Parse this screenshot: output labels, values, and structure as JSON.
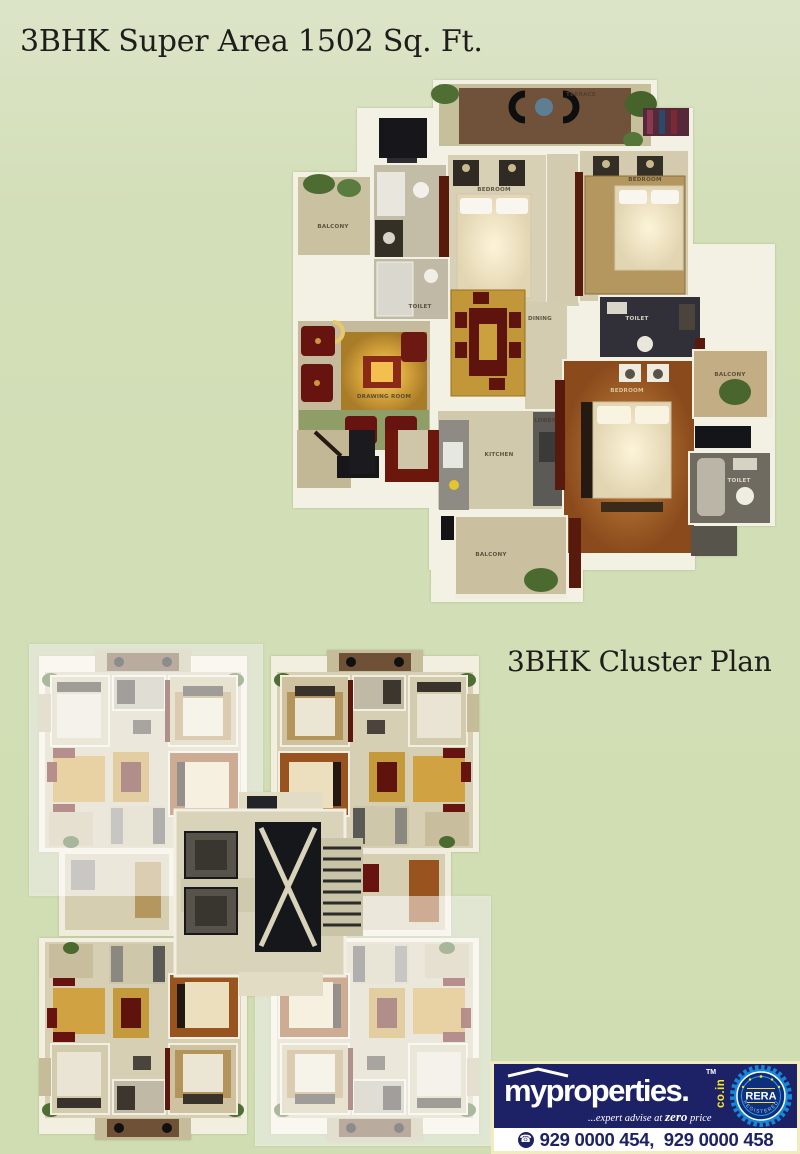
{
  "titles": {
    "main": "3BHK Super Area 1502 Sq. Ft.",
    "cluster": "3BHK Cluster Plan"
  },
  "floorplan": {
    "rooms": {
      "terrace": "TERRACE",
      "balcony_left": "BALCONY",
      "toilet_left": "TOILET",
      "bedroom_mid": "BEDROOM",
      "bedroom_right": "BEDROOM",
      "drawing_room": "DRAWING ROOM",
      "dining": "DINING",
      "kitchen": "KITCHEN",
      "lobby": "LOBBY",
      "master_bedroom": "BEDROOM",
      "toilet_master": "TOILET",
      "toilet_right": "TOILET",
      "balcony_right": "BALCONY",
      "balcony_bottom": "BALCONY"
    }
  },
  "footer": {
    "brand": "myproperties.",
    "trademark": "TM",
    "domain": "co.in",
    "tagline_prefix": "...expert advise at ",
    "tagline_zero": "zero",
    "tagline_suffix": " price",
    "rera_center": "RERA",
    "rera_bottom": "REGISTERED",
    "phones_label": "929 0000 454,  929 0000 458",
    "icons": {
      "phone": "☎"
    },
    "colors": {
      "navy": "#1d2266",
      "yellow": "#f6e829",
      "badge_blue": "#1487d8",
      "border_cream": "#f1ebc0"
    }
  }
}
